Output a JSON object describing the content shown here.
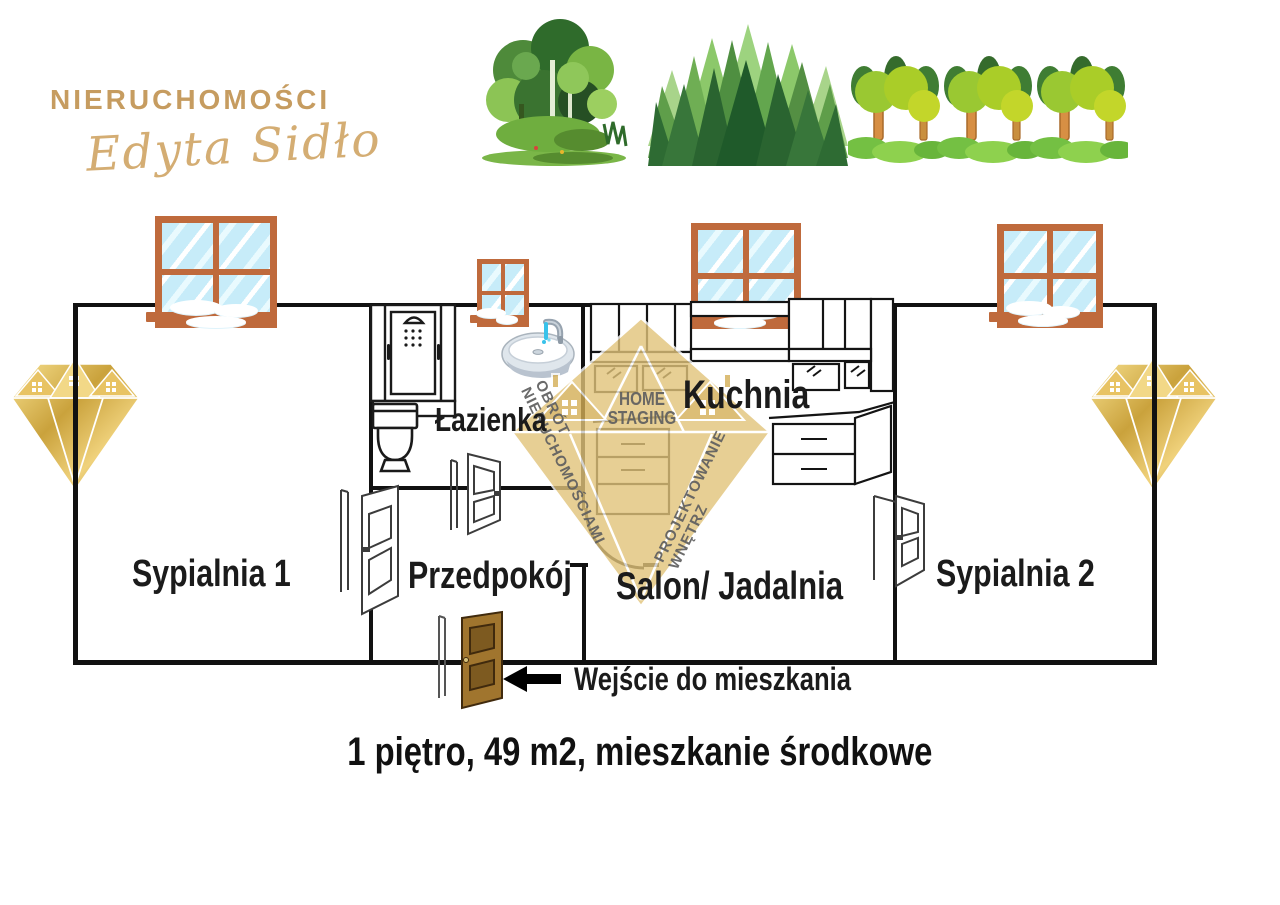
{
  "brand": {
    "name": "NIERUCHOMOŚCI",
    "owner": "Edyta Sidło"
  },
  "watermark": {
    "home": "HOME",
    "staging": "STAGING",
    "obrot": "OBRÓT",
    "nieruchomosciami": "NIERUCHOMOŚCIAMI",
    "projektowanie": "PROJEKTOWANIE",
    "wnetrz": "WNĘTRZ"
  },
  "floorplan": {
    "rooms": [
      {
        "id": "sypialnia-1",
        "label": "Sypialnia 1"
      },
      {
        "id": "lazienka",
        "label": "Łazienka"
      },
      {
        "id": "przedpokoj",
        "label": "Przedpokój"
      },
      {
        "id": "kuchnia",
        "label": "Kuchnia"
      },
      {
        "id": "salon-jadalnia",
        "label": "Salon/ Jadalnia"
      },
      {
        "id": "sypialnia-2",
        "label": "Sypialnia 2"
      }
    ],
    "entrance_label": "Wejście do mieszkania"
  },
  "caption": "1 piętro, 49 m2, mieszkanie środkowe",
  "icons": [
    "forest-clipart",
    "pine-forest-clipart",
    "tree-row-clipart",
    "window-icon",
    "shower-icon",
    "toilet-icon",
    "sink-icon",
    "kitchen-cabinets-icon",
    "interior-door-icon",
    "entrance-door-icon",
    "arrow-left-icon",
    "gold-diamond-logo",
    "diamond-house-watermark"
  ],
  "colors": {
    "brand_gold": "#c69c60",
    "watermark_gold": "#e2c47a",
    "wall_black": "#111111",
    "window_frame_brown": "#bf6a3c",
    "window_glass_blue": "#c7ecf9",
    "entrance_door_brown": "#a0752e",
    "label_black": "#1b1b1b"
  }
}
